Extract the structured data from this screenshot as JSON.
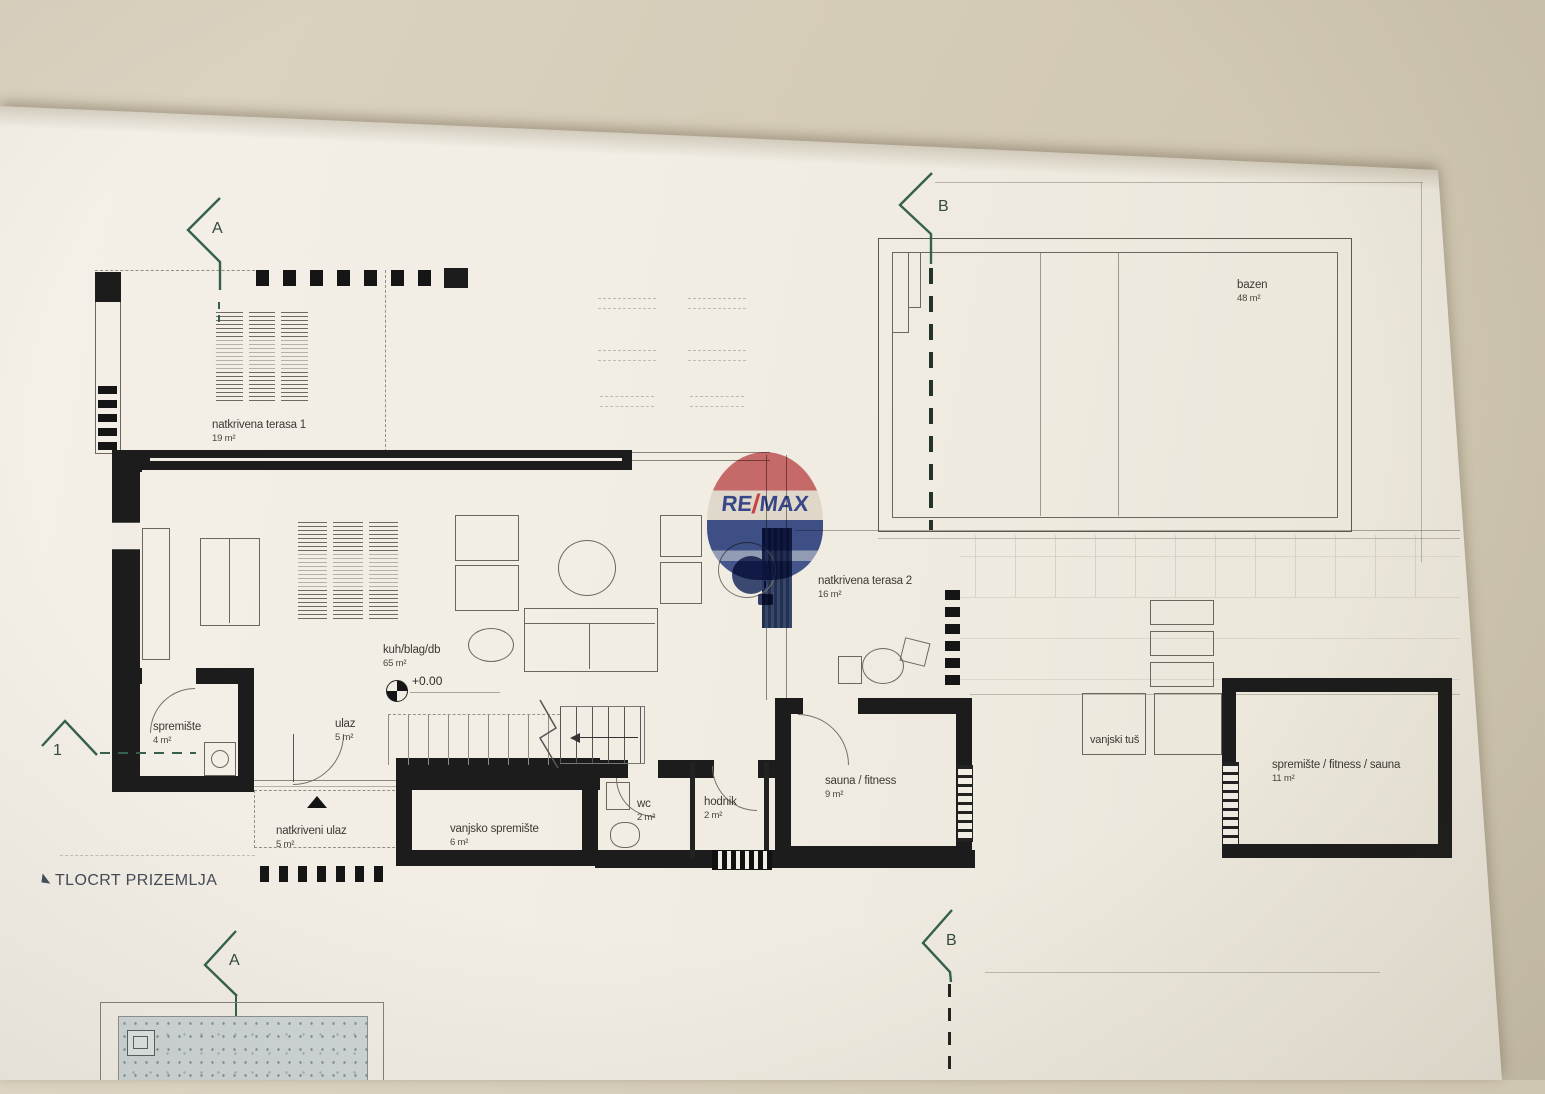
{
  "title": {
    "label": "TLOCRT PRIZEMLJA"
  },
  "logo": {
    "re": "RE",
    "slash": "/",
    "max": "MAX"
  },
  "markers": {
    "a": "A",
    "b": "B",
    "one": "1"
  },
  "annotations": {
    "elevation": "+0.00"
  },
  "rooms": {
    "terasa1": {
      "name": "natkrivena terasa 1",
      "area": "19 m²"
    },
    "bazen": {
      "name": "bazen",
      "area": "48 m²"
    },
    "terasa2": {
      "name": "natkrivena terasa 2",
      "area": "16 m²"
    },
    "kuh": {
      "name": "kuh/blag/db",
      "area": "65 m²"
    },
    "spremiste": {
      "name": "spremište",
      "area": "4 m²"
    },
    "ulaz": {
      "name": "ulaz",
      "area": "5 m²"
    },
    "natkriveni_ulaz": {
      "name": "natkriveni ulaz",
      "area": "5 m²"
    },
    "vanjsko_spremiste": {
      "name": "vanjsko spremište",
      "area": "6 m²"
    },
    "wc": {
      "name": "wc",
      "area": "2 m²"
    },
    "hodnik": {
      "name": "hodnik",
      "area": "2 m²"
    },
    "sauna": {
      "name": "sauna / fitness",
      "area": "9 m²"
    },
    "vanjski_tus": {
      "name": "vanjski tuš",
      "area": ""
    },
    "spremiste2": {
      "name": "spremište / fitness / sauna",
      "area": "11 m²"
    }
  },
  "colors": {
    "marker_green": "#35604d",
    "wall_black": "#1c1c1c",
    "logo_blue": "#2b3e91",
    "logo_red": "#d23a41",
    "paper": "#f1ede4",
    "desk": "#d3cab5"
  }
}
